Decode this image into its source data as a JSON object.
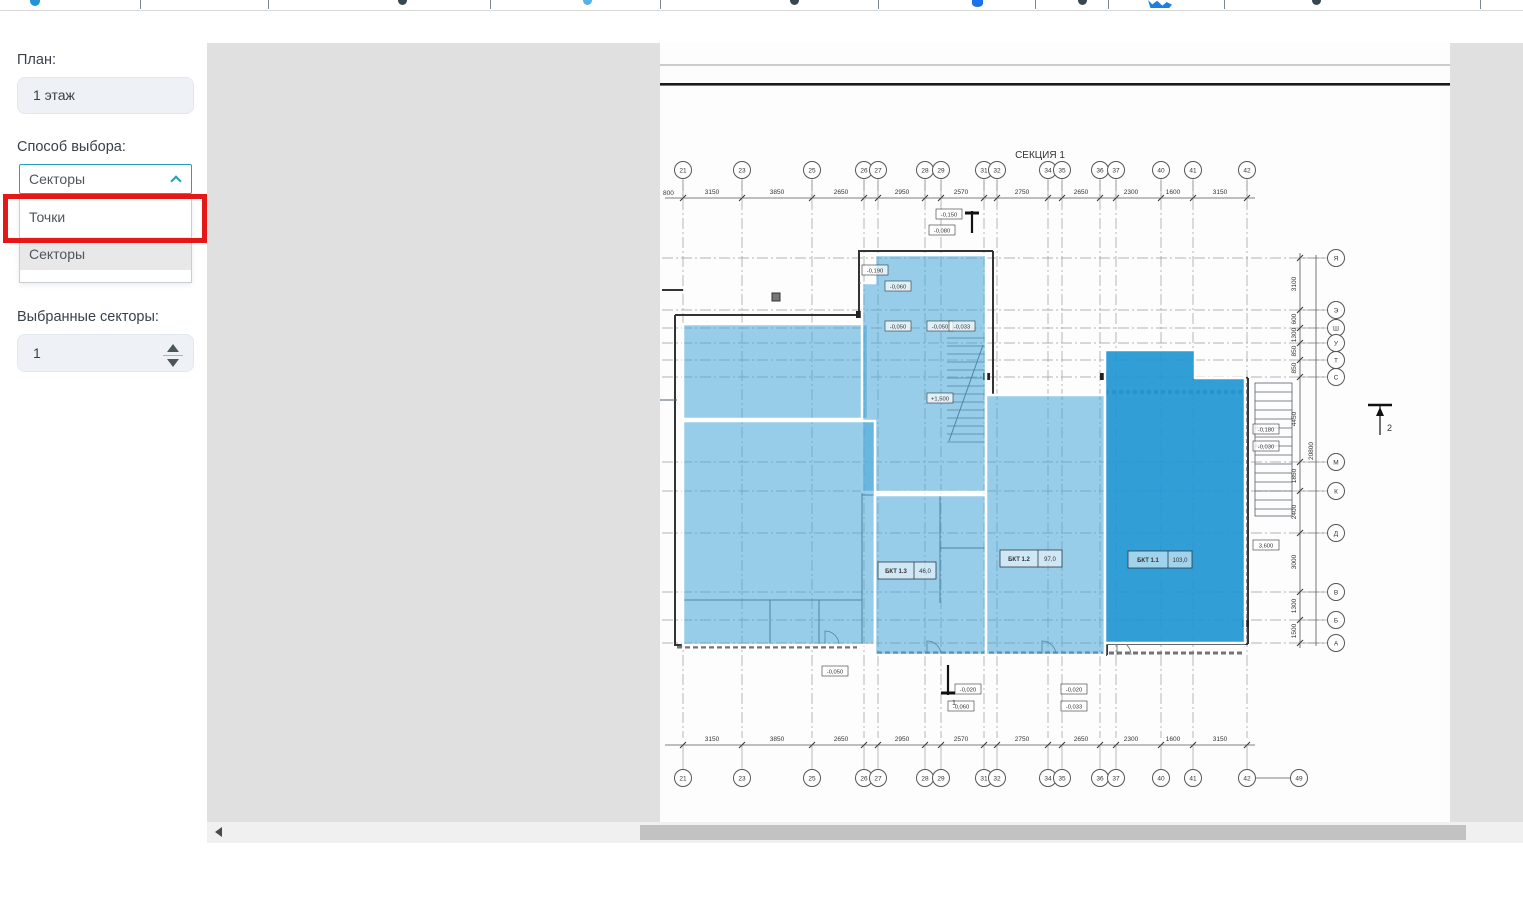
{
  "toolbar": {
    "fragments": [
      {
        "t": "blue",
        "x": 30
      },
      {
        "t": "sep",
        "x": 140
      },
      {
        "t": "sep",
        "x": 268
      },
      {
        "t": "dark",
        "x": 398
      },
      {
        "t": "sep",
        "x": 490
      },
      {
        "t": "lightblue",
        "x": 583
      },
      {
        "t": "sep",
        "x": 660
      },
      {
        "t": "dark",
        "x": 790
      },
      {
        "t": "sep",
        "x": 878
      },
      {
        "t": "pin",
        "x": 972
      },
      {
        "t": "sep",
        "x": 1035
      },
      {
        "t": "dark",
        "x": 1078
      },
      {
        "t": "sep",
        "x": 1108
      },
      {
        "t": "bird",
        "x": 1148
      },
      {
        "t": "sep",
        "x": 1224
      },
      {
        "t": "dark",
        "x": 1312
      },
      {
        "t": "sep",
        "x": 1480
      }
    ]
  },
  "sidebar": {
    "plan_label": "План:",
    "plan_value": "1 этаж",
    "method_label": "Способ выбора:",
    "method_value": "Секторы",
    "method_options": [
      {
        "label": "Точки",
        "selected": false
      },
      {
        "label": "Секторы",
        "selected": true
      }
    ],
    "selected_label": "Выбранные секторы:",
    "selected_value": "1",
    "accent_color": "#18a2b8",
    "annotation_color": "#e51717"
  },
  "plan": {
    "section_title": "СЕКЦИЯ 1",
    "left_cut_dim": "800",
    "cols": [
      [
        "21",
        476
      ],
      [
        "23",
        535
      ],
      [
        "25",
        605
      ],
      [
        "26",
        657
      ],
      [
        "27",
        671
      ],
      [
        "28",
        718
      ],
      [
        "29",
        734
      ],
      [
        "31",
        777
      ],
      [
        "32",
        790
      ],
      [
        "34",
        841
      ],
      [
        "35",
        855
      ],
      [
        "36",
        893
      ],
      [
        "37",
        909
      ],
      [
        "40",
        954
      ],
      [
        "41",
        986
      ],
      [
        "42",
        1040
      ]
    ],
    "extra_col": [
      "49",
      1092
    ],
    "rows": [
      [
        "Я",
        215
      ],
      [
        "Э",
        267
      ],
      [
        "Ш",
        285
      ],
      [
        "У",
        300
      ],
      [
        "Т",
        317
      ],
      [
        "С",
        334
      ],
      [
        "М",
        419
      ],
      [
        "К",
        448
      ],
      [
        "Д",
        490
      ],
      [
        "В",
        549
      ],
      [
        "Б",
        577
      ],
      [
        "А",
        600
      ]
    ],
    "hdims": [
      [
        "3150",
        505
      ],
      [
        "3850",
        570
      ],
      [
        "2650",
        634
      ],
      [
        "2950",
        695
      ],
      [
        "2570",
        754
      ],
      [
        "2750",
        815
      ],
      [
        "2650",
        874
      ],
      [
        "2300",
        924
      ],
      [
        "1600",
        966
      ],
      [
        "3150",
        1013
      ]
    ],
    "vdims": [
      [
        "3100",
        241
      ],
      [
        "600",
        276
      ],
      [
        "1300",
        292
      ],
      [
        "850",
        308
      ],
      [
        "850",
        325
      ],
      [
        "4450",
        376
      ],
      [
        "1850",
        433
      ],
      [
        "2400",
        469
      ],
      [
        "3000",
        519
      ],
      [
        "1300",
        563
      ],
      [
        "1500",
        588
      ]
    ],
    "vtotal": "20800",
    "rooms": [
      [
        "БКТ 1.3",
        "46,0",
        671,
        519,
        58
      ],
      [
        "БКТ 1.2",
        "97,0",
        793,
        507,
        62
      ],
      [
        "БКТ 1.1",
        "103,0",
        921,
        508,
        64
      ]
    ],
    "elevations": [
      [
        "-0,150",
        729,
        166
      ],
      [
        "-0,080",
        722,
        182
      ],
      [
        "-0,190",
        655,
        222
      ],
      [
        "-0,060",
        678,
        238
      ],
      [
        "-0,050",
        678,
        278
      ],
      [
        "-0,050",
        720,
        278
      ],
      [
        "-0,033",
        742,
        278
      ],
      [
        "+1,500",
        720,
        350
      ],
      [
        "-0,050",
        615,
        623
      ],
      [
        "-0,020",
        748,
        641
      ],
      [
        "-0,060",
        741,
        658
      ],
      [
        "-0,020",
        854,
        641
      ],
      [
        "-0,033",
        854,
        658
      ],
      [
        "-0,180",
        1046,
        381
      ],
      [
        "-0,030",
        1046,
        398
      ],
      [
        "3,600",
        1046,
        497
      ]
    ],
    "sectors": [
      {
        "id": "sector-upper-left",
        "points": "476,281 661,281 661,376 476,376",
        "selected": false
      },
      {
        "id": "sector-core",
        "points": "655,240 668,240 668,212 779,212 779,449 655,449",
        "selected": false
      },
      {
        "id": "sector-lower-left",
        "points": "476,378 668,378 668,602 476,602",
        "selected": false
      },
      {
        "id": "sector-mid-bottom",
        "points": "668,452 779,452 779,612 668,612",
        "selected": false
      },
      {
        "id": "sector-center-right",
        "points": "779,352 898,352 898,612 779,612",
        "selected": false
      },
      {
        "id": "sector-right-selected",
        "points": "898,307 988,307 988,335 1038,335 1038,600 898,600",
        "selected": true
      }
    ],
    "walls": [
      [
        "M468,272 H652",
        2
      ],
      [
        "M652,272 V208 H786",
        2
      ],
      [
        "M786,208 V352 H898",
        2
      ],
      [
        "M898,352 V307 H988",
        2
      ],
      [
        "M988,307 V335 H1041",
        2
      ],
      [
        "M1041,335 V601",
        2
      ],
      [
        "M468,272 V602 H668",
        2
      ],
      [
        "M668,602 V612 H900",
        2
      ],
      [
        "M900,612 V601 H1041",
        2
      ],
      [
        "M655,272 V602",
        1
      ],
      [
        "M668,378 V602",
        1
      ],
      [
        "M779,212 V612",
        1
      ],
      [
        "M898,352 V612",
        1
      ],
      [
        "M476,378 H652",
        1
      ],
      [
        "M655,452 H779",
        1
      ],
      [
        "M779,352 H898",
        1
      ],
      [
        "M476,557 H655",
        1
      ],
      [
        "M563,557 V602",
        1
      ],
      [
        "M612,557 V602",
        1
      ],
      [
        "M733,452 V560",
        1
      ],
      [
        "M733,505 H779",
        1
      ],
      [
        "M455,247 H476",
        2
      ],
      [
        "M453,357 H470",
        1
      ],
      [
        "M652,240 H668",
        1
      ],
      [
        "M898,349 H1039",
        4,
        "4 3"
      ],
      [
        "M1039,340 V598",
        4,
        "4 3"
      ],
      [
        "M470,604 H650",
        3,
        "5 3"
      ],
      [
        "M670,610 H896",
        3,
        "5 3"
      ],
      [
        "M902,610 H1038",
        3,
        "5 3"
      ],
      [
        "M742,398 L776,302",
        1
      ]
    ],
    "door_arcs": [
      [
        618,
        602
      ],
      [
        720,
        612
      ],
      [
        835,
        612
      ],
      [
        910,
        612
      ]
    ],
    "squares": [
      [
        776,
        330
      ],
      [
        893,
        330
      ],
      [
        649,
        268
      ],
      [
        1035,
        577
      ]
    ],
    "section_markers": {
      "right": "2",
      "bottom": "1"
    },
    "colors": {
      "sector_fill": "#44a5d9",
      "sector_selected_fill": "#1f96d2"
    }
  }
}
